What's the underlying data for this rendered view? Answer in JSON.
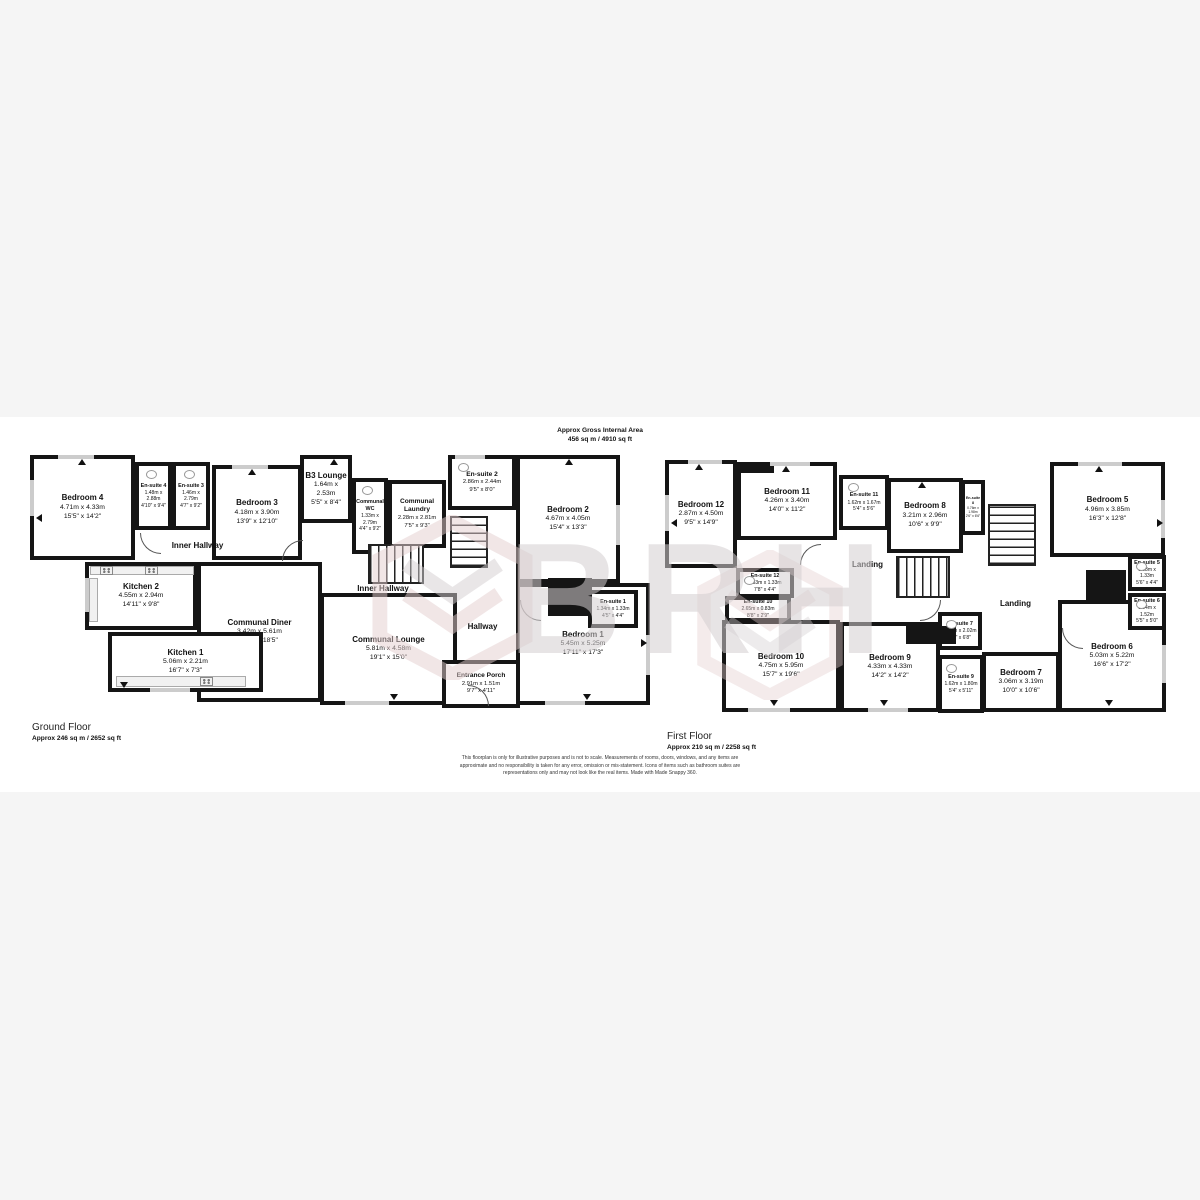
{
  "header": {
    "line1": "Approx Gross Internal Area",
    "line2": "456 sq m / 4910 sq ft"
  },
  "ground_floor": {
    "title": "Ground Floor",
    "area": "Approx 246 sq m / 2652 sq ft",
    "rooms": {
      "bedroom_4": {
        "name": "Bedroom 4",
        "metric": "4.71m x 4.33m",
        "imperial": "15'5\" x 14'2\""
      },
      "ensuite_4": {
        "name": "En-suite 4",
        "metric": "1.48m x 2.88m",
        "imperial": "4'10\" x 9'4\""
      },
      "ensuite_3": {
        "name": "En-suite 3",
        "metric": "1.46m x 2.79m",
        "imperial": "4'7\" x 9'2\""
      },
      "bedroom_3": {
        "name": "Bedroom 3",
        "metric": "4.18m x 3.90m",
        "imperial": "13'9\" x 12'10\""
      },
      "b3_lounge": {
        "name": "B3 Lounge",
        "metric": "1.64m x 2.53m",
        "imperial": "5'5\" x 8'4\""
      },
      "communal_wc": {
        "name": "Communal WC",
        "metric": "1.33m x 2.79m",
        "imperial": "4'4\" x 9'2\""
      },
      "communal_laundry": {
        "name": "Communal Laundry",
        "metric": "2.28m x 2.81m",
        "imperial": "7'5\" x 9'3\""
      },
      "ensuite_2": {
        "name": "En-suite 2",
        "metric": "2.86m x 2.44m",
        "imperial": "9'5\" x 8'0\""
      },
      "bedroom_2": {
        "name": "Bedroom 2",
        "metric": "4.67m x 4.05m",
        "imperial": "15'4\" x 13'3\""
      },
      "ensuite_1": {
        "name": "En-suite 1",
        "metric": "1.34m x 1.33m",
        "imperial": "4'5\" x 4'4\""
      },
      "bedroom_1": {
        "name": "Bedroom 1",
        "metric": "5.45m x 5.25m",
        "imperial": "17'11\" x 17'3\""
      },
      "kitchen_2": {
        "name": "Kitchen 2",
        "metric": "4.55m x 2.94m",
        "imperial": "14'11\" x 9'8\""
      },
      "kitchen_1": {
        "name": "Kitchen 1",
        "metric": "5.06m x 2.21m",
        "imperial": "16'7\" x 7'3\""
      },
      "communal_diner": {
        "name": "Communal Diner",
        "metric": "3.42m x 5.61m",
        "imperial": "11'3\" x 18'5\""
      },
      "communal_lounge": {
        "name": "Communal Lounge",
        "metric": "5.81m x 4.58m",
        "imperial": "19'1\" x 15'0\""
      },
      "entrance_porch": {
        "name": "Entrance Porch",
        "metric": "2.91m x 1.51m",
        "imperial": "9'7\" x 4'11\""
      },
      "inner_hallway_top": {
        "name": "Inner Hallway"
      },
      "inner_hallway_mid": {
        "name": "Inner Hallway"
      },
      "hallway": {
        "name": "Hallway"
      }
    }
  },
  "first_floor": {
    "title": "First Floor",
    "area": "Approx 210 sq m / 2258 sq ft",
    "rooms": {
      "bedroom_12": {
        "name": "Bedroom 12",
        "metric": "2.87m x 4.50m",
        "imperial": "9'5\" x 14'9\""
      },
      "bedroom_11": {
        "name": "Bedroom 11",
        "metric": "4.26m x 3.40m",
        "imperial": "14'0\" x 11'2\""
      },
      "ensuite_11": {
        "name": "En-suite 11",
        "metric": "1.62m x 1.67m",
        "imperial": "5'4\" x 5'6\""
      },
      "bedroom_8": {
        "name": "Bedroom 8",
        "metric": "3.21m x 2.96m",
        "imperial": "10'6\" x 9'9\""
      },
      "ensuite_8": {
        "name": "En-suite 8",
        "metric": "0.76m x 1.98m",
        "imperial": "2'6\" x 6'6\""
      },
      "bedroom_5": {
        "name": "Bedroom 5",
        "metric": "4.96m x 3.85m",
        "imperial": "16'3\" x 12'8\""
      },
      "ensuite_5": {
        "name": "En-suite 5",
        "metric": "1.68m x 1.33m",
        "imperial": "5'6\" x 4'4\""
      },
      "ensuite_6": {
        "name": "En-suite 6",
        "metric": "1.64m x 1.52m",
        "imperial": "5'5\" x 5'0\""
      },
      "bedroom_6": {
        "name": "Bedroom 6",
        "metric": "5.03m x 5.22m",
        "imperial": "16'6\" x 17'2\""
      },
      "bedroom_7": {
        "name": "Bedroom 7",
        "metric": "3.06m x 3.19m",
        "imperial": "10'0\" x 10'6\""
      },
      "ensuite_7": {
        "name": "En-suite 7",
        "metric": "1.61m x 2.02m",
        "imperial": "5'3\" x 6'8\""
      },
      "ensuite_9": {
        "name": "En-suite 9",
        "metric": "1.62m x 1.80m",
        "imperial": "5'4\" x 5'11\""
      },
      "bedroom_9": {
        "name": "Bedroom 9",
        "metric": "4.33m x 4.33m",
        "imperial": "14'2\" x 14'2\""
      },
      "bedroom_10": {
        "name": "Bedroom 10",
        "metric": "4.75m x 5.95m",
        "imperial": "15'7\" x 19'6\""
      },
      "ensuite_12": {
        "name": "En-suite 12",
        "metric": "2.33m x 1.33m",
        "imperial": "7'8\" x 4'4\""
      },
      "ensuite_10": {
        "name": "En-suite 10",
        "metric": "2.65m x 0.83m",
        "imperial": "8'8\" x 2'9\""
      },
      "landing_left": {
        "name": "Landing"
      },
      "landing_right": {
        "name": "Landing"
      }
    }
  },
  "watermark": {
    "text": "BRH"
  },
  "disclaimer": "This floorplan is only for illustrative purposes and is not to scale. Measurements of rooms, doors, windows, and any items are approximate and no responsibility is taken for any error, omission or mis-statement. Icons of items such as bathroom suites are representations only and may not look like the real items. Made with Made Snappy 360.",
  "colors": {
    "wall": "#151515",
    "window": "#cccccc",
    "watermark_grey": "#d4cfd1",
    "watermark_pink": "#e4cecf"
  }
}
